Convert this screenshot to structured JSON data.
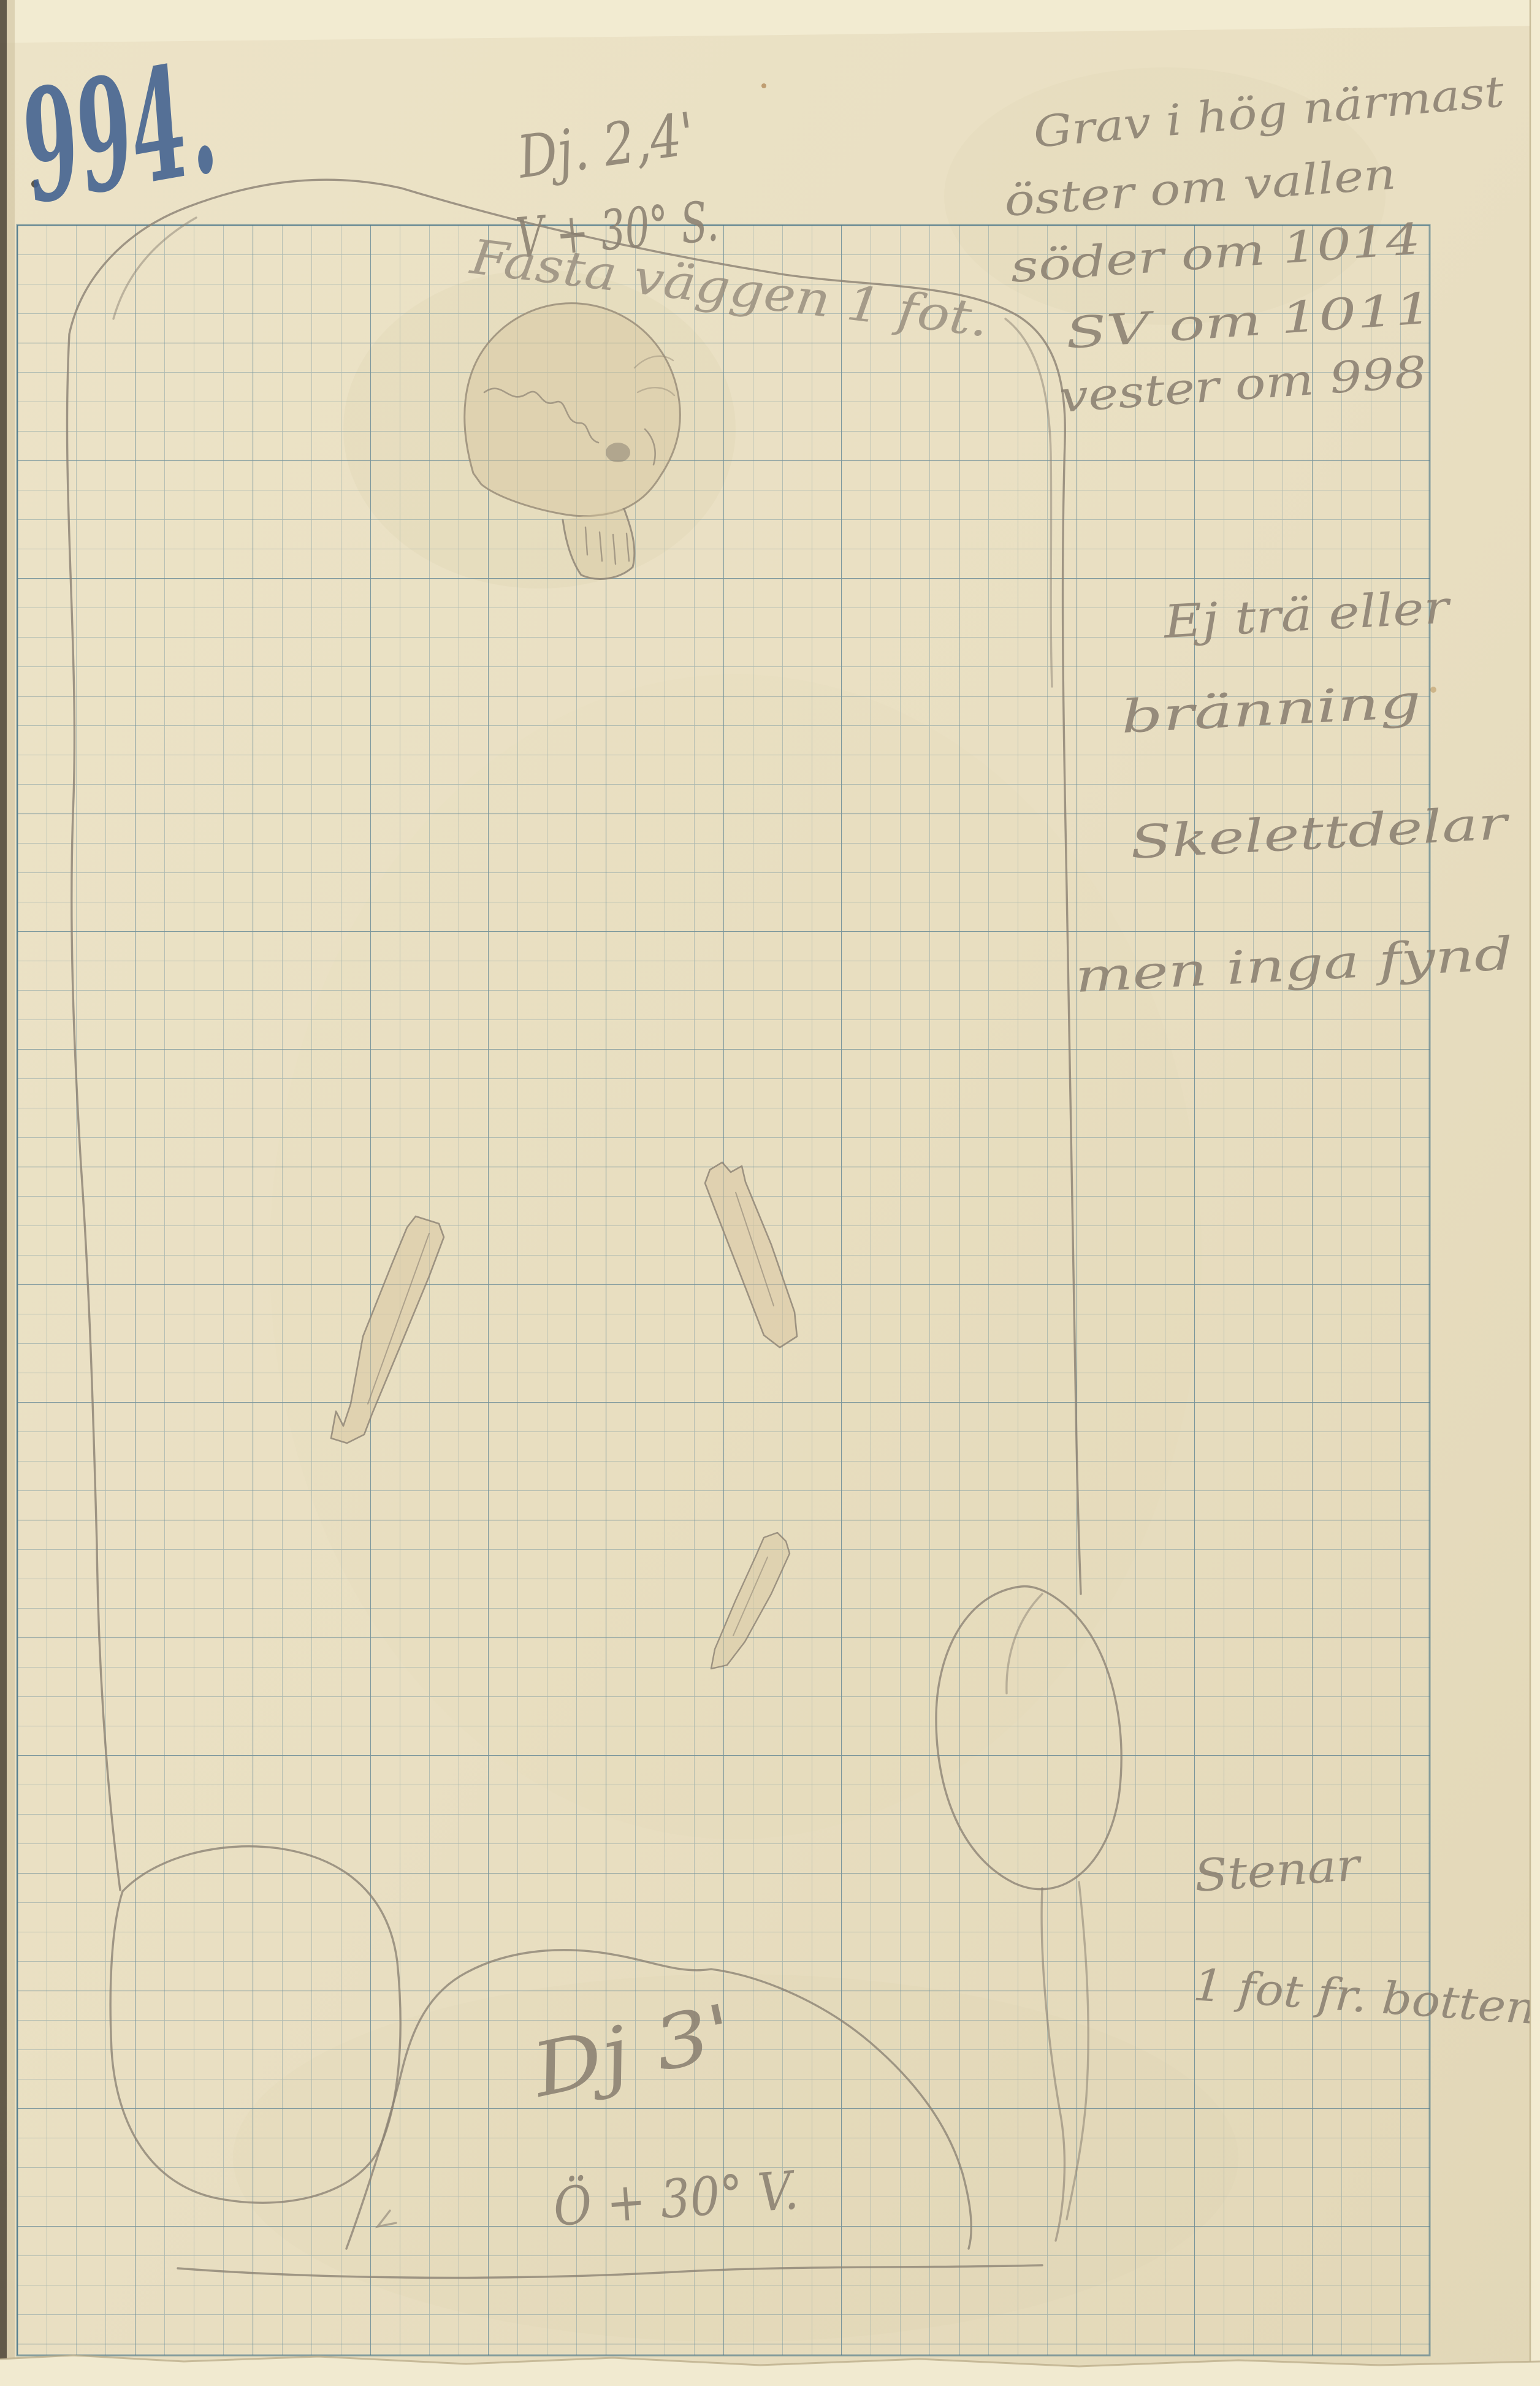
{
  "page": {
    "number": "994.",
    "ink_color": "#40608f"
  },
  "notes": {
    "top_center": {
      "line1": "Dj. 2,4'",
      "line2": "V + 30° S.",
      "line3": "Fasta väggen 1 fot."
    },
    "top_right": {
      "line1": "Grav i hög närmast",
      "line2": "öster om vallen",
      "line3": "söder om 1014",
      "line4": "SV om 1011",
      "line5": "vester om 998"
    },
    "mid_right": {
      "line1": "Ej trä eller",
      "line2": "bränning",
      "line3": "Skelettdelar",
      "line4": "men inga fynd"
    },
    "bottom_right": {
      "line1": "Stenar",
      "line2": "1 fot fr. botten"
    },
    "bottom_center": {
      "line1": "Dj 3'",
      "line2": "Ö + 30° V."
    }
  },
  "drawing": {
    "features": [
      {
        "name": "grave-outline",
        "description": "pencil outline of grave cut"
      },
      {
        "name": "skull",
        "description": "human skull in profile at head end"
      },
      {
        "name": "long-bone-left",
        "description": "diagonal long bone"
      },
      {
        "name": "long-bone-right",
        "description": "diagonal long bone"
      },
      {
        "name": "bone-fragment",
        "description": "small bone fragment"
      },
      {
        "name": "stone-oval",
        "description": "large stone, lower left"
      },
      {
        "name": "stone-mound",
        "description": "large stone mound, bottom centre"
      },
      {
        "name": "stone-circle",
        "description": "round stone right of mound"
      }
    ],
    "colors": {
      "paper": "#e9dfc2",
      "grid": "#5f8fa6",
      "pencil": "#8b8173",
      "bone_wash": "#d8c7a2",
      "page_number_ink": "#40608f"
    }
  }
}
